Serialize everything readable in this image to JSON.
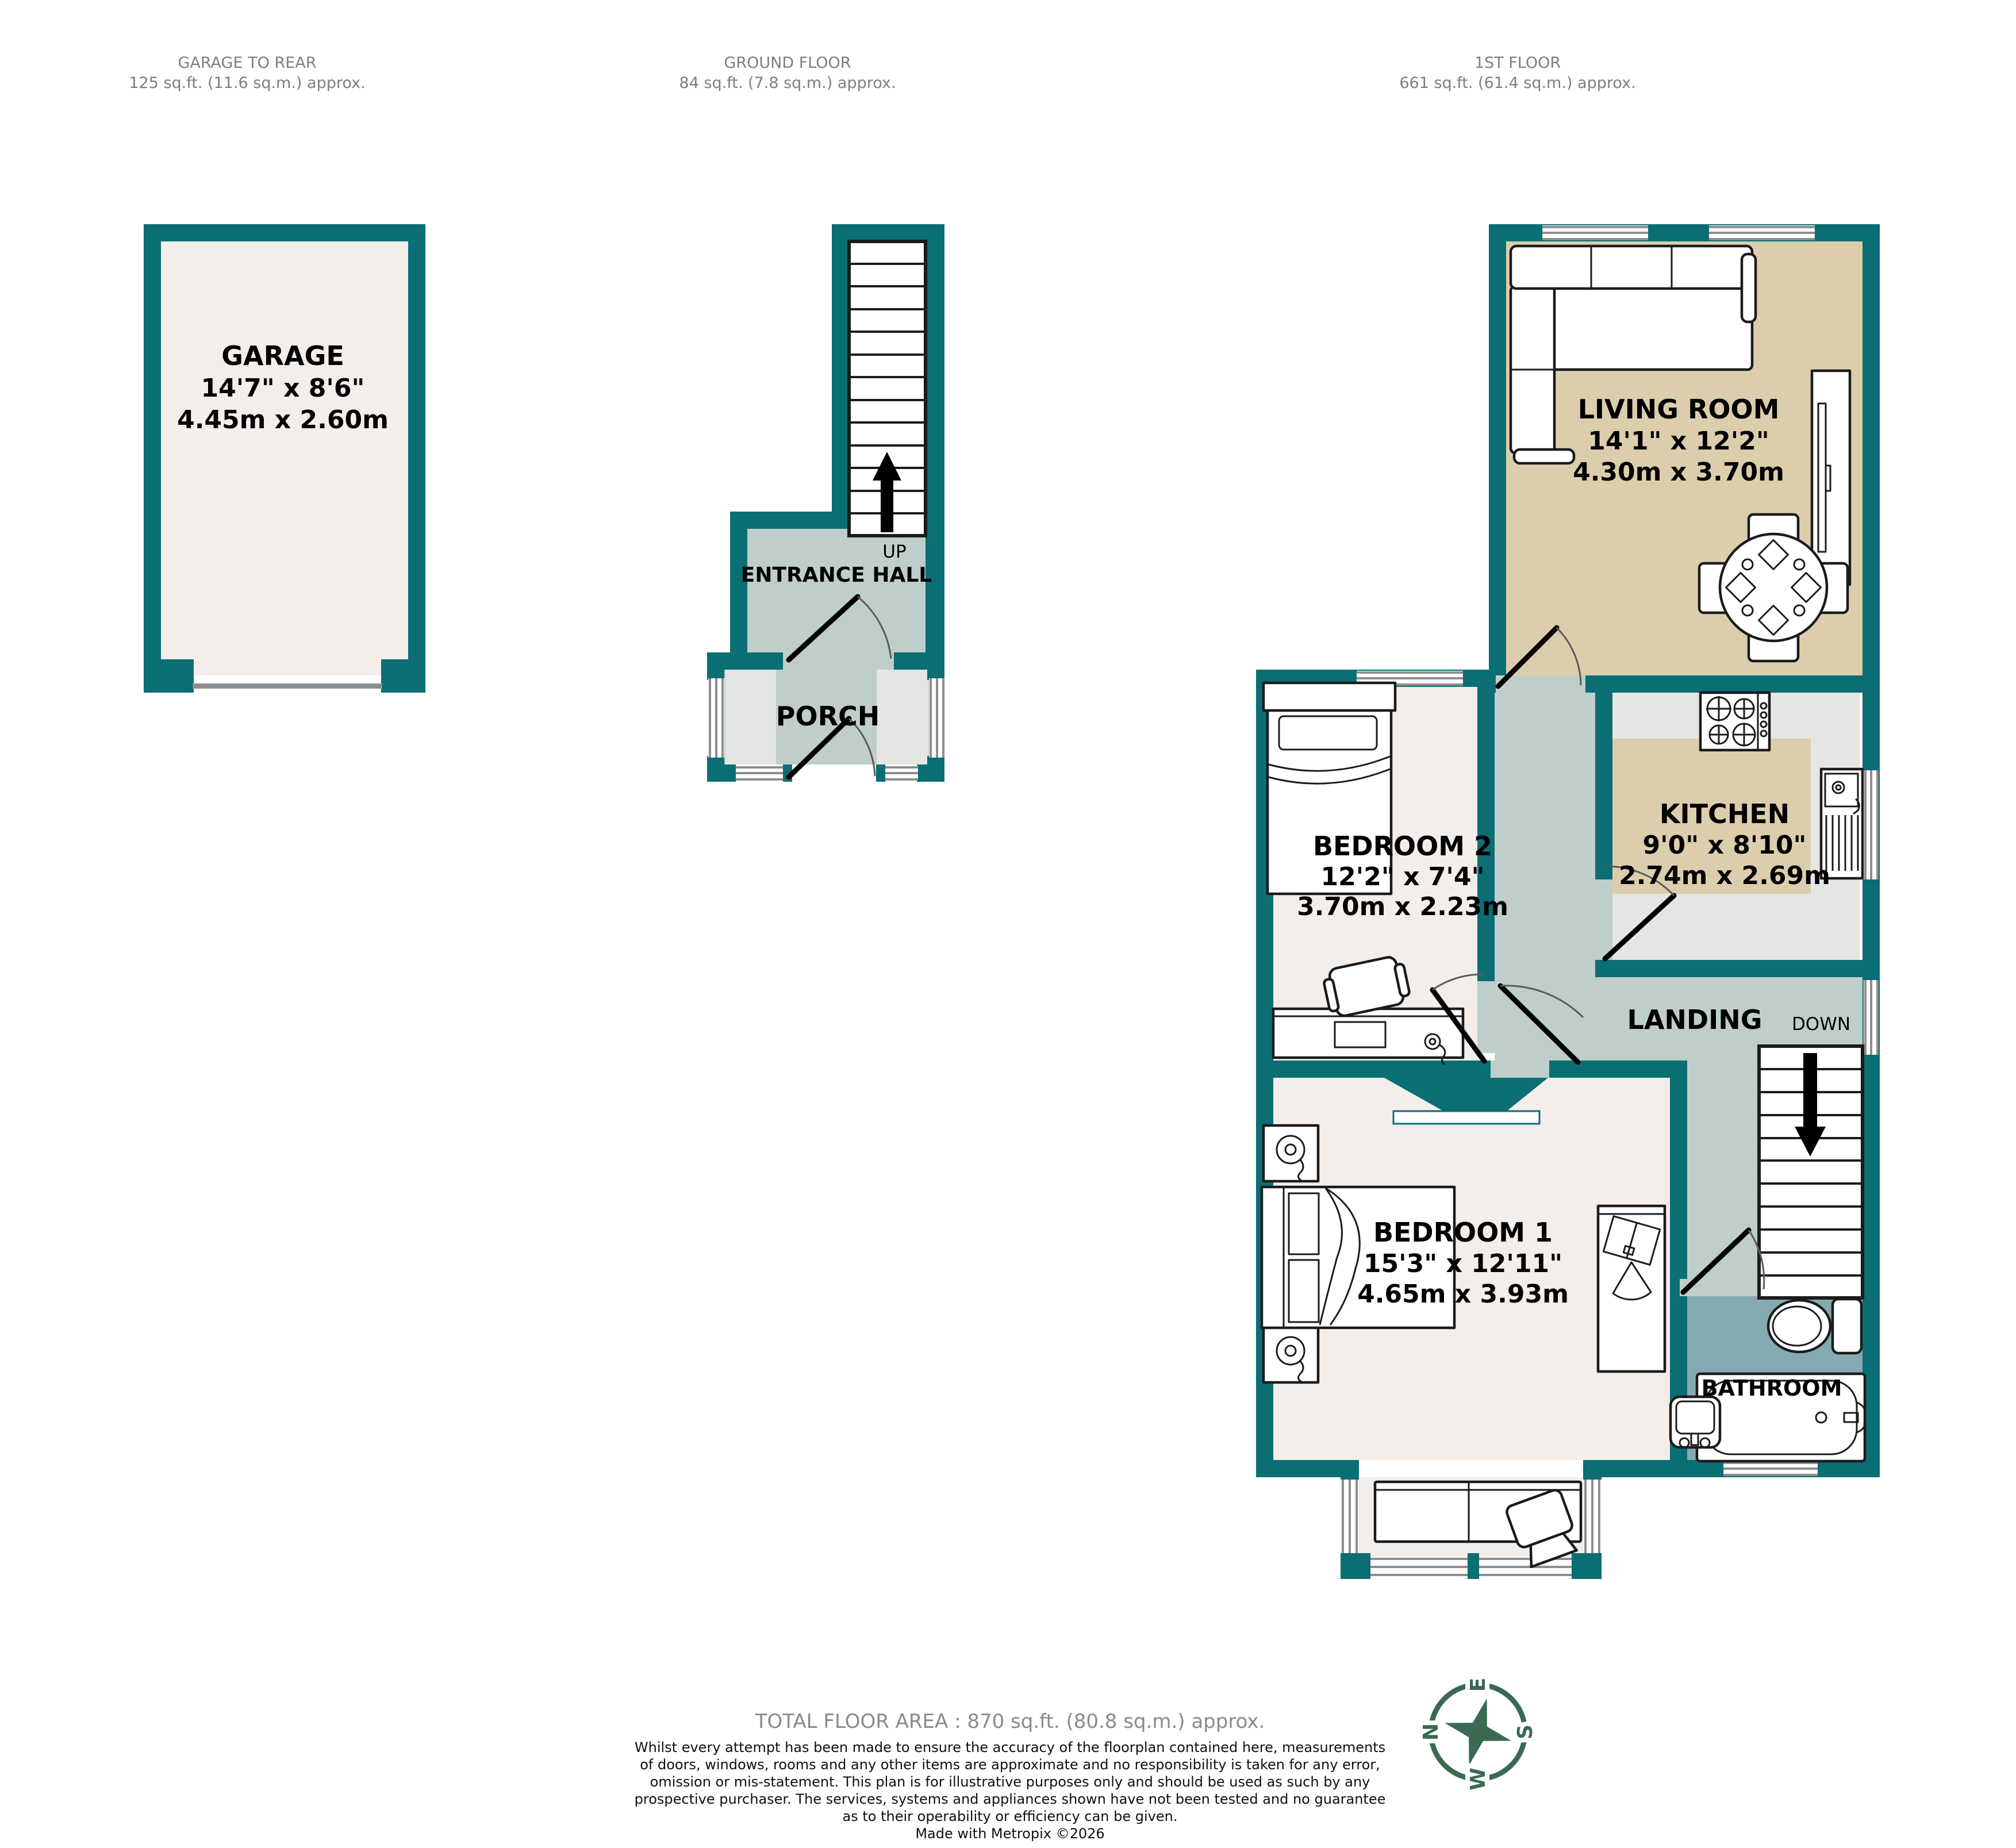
{
  "plans": {
    "garage": {
      "title": "GARAGE TO REAR",
      "subtitle": "125 sq.ft. (11.6 sq.m.) approx."
    },
    "ground": {
      "title": "GROUND FLOOR",
      "subtitle": "84 sq.ft. (7.8 sq.m.) approx."
    },
    "first": {
      "title": "1ST FLOOR",
      "subtitle": "661 sq.ft. (61.4 sq.m.) approx."
    }
  },
  "rooms": {
    "garage": {
      "name": "GARAGE",
      "imperial": "14'7\" x 8'6\"",
      "metric": "4.45m x 2.60m"
    },
    "entrance_hall": {
      "name": "ENTRANCE HALL"
    },
    "porch": {
      "name": "PORCH"
    },
    "living_room": {
      "name": "LIVING ROOM",
      "imperial": "14'1\" x 12'2\"",
      "metric": "4.30m x 3.70m"
    },
    "kitchen": {
      "name": "KITCHEN",
      "imperial": "9'0\" x 8'10\"",
      "metric": "2.74m x 2.69m"
    },
    "bedroom2": {
      "name": "BEDROOM 2",
      "imperial": "12'2\" x 7'4\"",
      "metric": "3.70m x 2.23m"
    },
    "bedroom1": {
      "name": "BEDROOM 1",
      "imperial": "15'3\" x 12'11\"",
      "metric": "4.65m x 3.93m"
    },
    "landing": {
      "name": "LANDING"
    },
    "bathroom": {
      "name": "BATHROOM"
    }
  },
  "stairs": {
    "up": "UP",
    "down": "DOWN"
  },
  "compass": {
    "north": "N",
    "east": "E",
    "south": "S",
    "west": "W"
  },
  "footer": {
    "total": "TOTAL FLOOR AREA : 870 sq.ft. (80.8 sq.m.) approx.",
    "disclaimer_lines": [
      "Whilst every attempt has been made to ensure the accuracy of the floorplan contained here, measurements",
      "of doors, windows, rooms and any other items are approximate and no responsibility is taken for any error,",
      "omission or mis-statement. This plan is for illustrative purposes only and should be used as such by any",
      "prospective purchaser. The services, systems and appliances shown have not been tested and no guarantee",
      "as to their operability or efficiency can be given."
    ],
    "credit": "Made with Metropix ©2026"
  },
  "colors": {
    "wall_teal": "#0A6E74",
    "room_cream": "#F4EEEB",
    "room_tan": "#DCCEAD",
    "hall_green_gray": "#BFCECB",
    "bathroom_blue": "#85A9B1",
    "light_gray": "#E4E6E3",
    "window_gray": "#8E8E8E",
    "compass_green": "#3A6A52",
    "header_gray": "#7E7E7E"
  }
}
